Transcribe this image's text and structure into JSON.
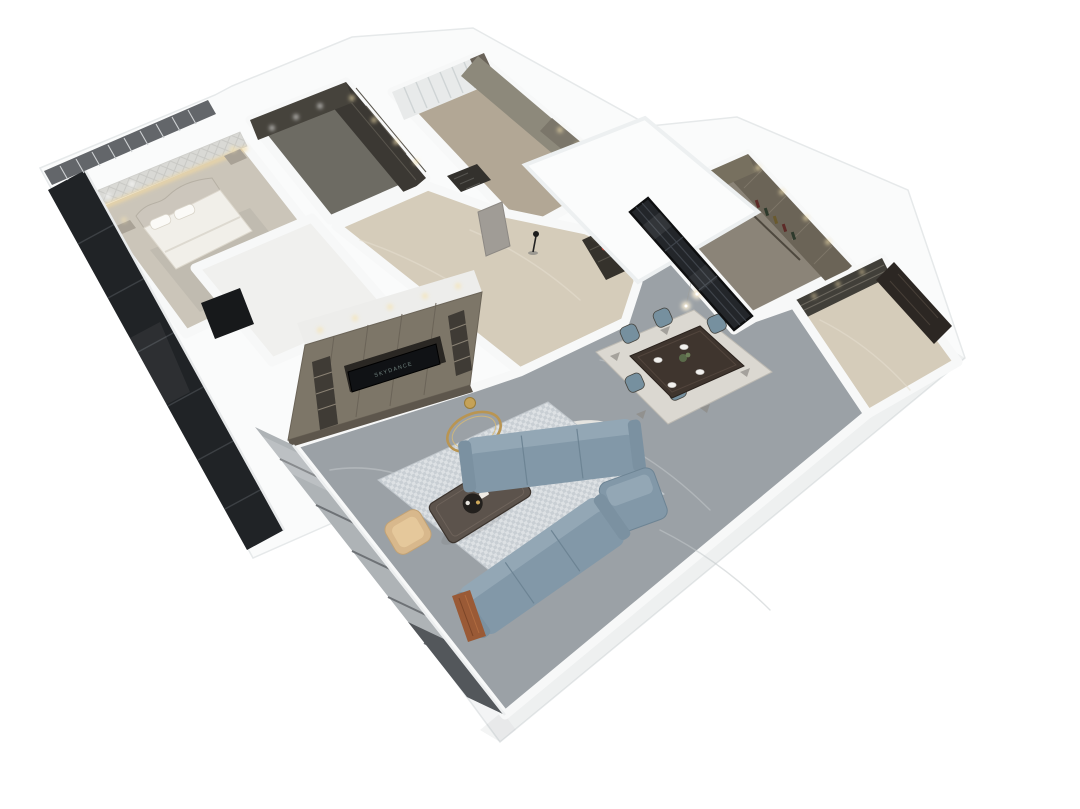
{
  "scene": {
    "type": "isometric-dollhouse-floorplan-render",
    "background": "#ffffff"
  },
  "palette": {
    "wall": "#f7f8f8",
    "wall-shade": "#e9ebec",
    "floor-marble": "#9ba1a6",
    "floor-marble-vein": "#c3c8cb",
    "floor-beige": "#d5ccba",
    "floor-bedroom": "#cbc5b9",
    "floor-closet": "#6d6b63",
    "floor-bed2": "#b2a795",
    "floor-kitchen": "#8b8478",
    "cabinet-olive": "#7d7668",
    "cabinet-dark": "#44403a",
    "wardrobe-dark": "#3b3833",
    "glass-dark": "#202326",
    "glass-frost": "#aeb3b6",
    "partition-glass": "#23262a",
    "sofa-blue": "#8298a8",
    "chair-blue": "#76909f",
    "rug-white": "#e9e8e3",
    "rug-dining": "#dbd8d1",
    "table-dark": "#3f352e",
    "entry-door": "#2c2723",
    "gold": "#b99552",
    "tan-chair": "#d8b88c",
    "coffee-marble": "#5c534c",
    "accent-glow": "#f2d9a2",
    "light-warm": "#f6e3b0",
    "red-accent": "#b23a2c",
    "green-plant": "#5a6b4a",
    "bed-white": "#f1efe9",
    "headboard": "#ccc6bc",
    "accent-wall": "#d9d9d5",
    "curtain-white": "#e8eaea",
    "curtain-dark": "#6a6359",
    "wall-olive": "#8d897b"
  },
  "living_room": {
    "tv_logo_text": "SKYDANCE"
  },
  "rooms": [
    {
      "id": "master-bedroom",
      "name": "Master Bedroom",
      "furniture": [
        "bed with arched quilted headboard",
        "white bedding and pillows",
        "two nightstands with lamps",
        "textured accent wall with warm cove lighting",
        "ceiling downlights",
        "dark floor-to-ceiling windows"
      ]
    },
    {
      "id": "walk-in-closet",
      "name": "Walk-in Closet",
      "furniture": [
        "dark open wardrobe shelving with cubbies",
        "hanging clothes",
        "ceiling spotlights"
      ]
    },
    {
      "id": "second-bedroom",
      "name": "Second Bedroom",
      "furniture": [
        "white sheer curtain wall",
        "dark drape panel",
        "olive feature wall with lit wardrobe niche",
        "floor vent grille"
      ]
    },
    {
      "id": "study-room",
      "name": "Unfurnished White Room",
      "furniture": [
        "dark doorway opening"
      ]
    },
    {
      "id": "hallway",
      "name": "Hallway",
      "furniture": [
        "beige marble floor",
        "interior door",
        "black coat stand",
        "dark display cabinet with red jars"
      ]
    },
    {
      "id": "kitchen",
      "name": "Kitchen",
      "furniture": [
        "black-framed glass partition",
        "olive cabinetry",
        "wine shelf with bottles",
        "ceiling downlights"
      ]
    },
    {
      "id": "entry-hall",
      "name": "Entry Hall",
      "furniture": [
        "dark wood entry door",
        "glass display cabinet with warm lights"
      ]
    },
    {
      "id": "dining-area",
      "name": "Dining Area",
      "furniture": [
        "dark walnut dining table",
        "six blue-gray upholstered chairs",
        "white place settings",
        "green centerpiece plant",
        "two globe pendant lights",
        "patterned area rug"
      ]
    },
    {
      "id": "living-room",
      "name": "Living Room",
      "furniture": [
        "built-in TV wall unit with shelving niches",
        "wall TV with faint logo",
        "L-shaped blue-gray sectional sofa",
        "dark marble coffee table with decor tray",
        "gold ring floor decor",
        "gold dish",
        "tan accent chair",
        "checkered rug",
        "round white rug",
        "floor-to-ceiling window wall",
        "rust colored throw"
      ]
    }
  ]
}
